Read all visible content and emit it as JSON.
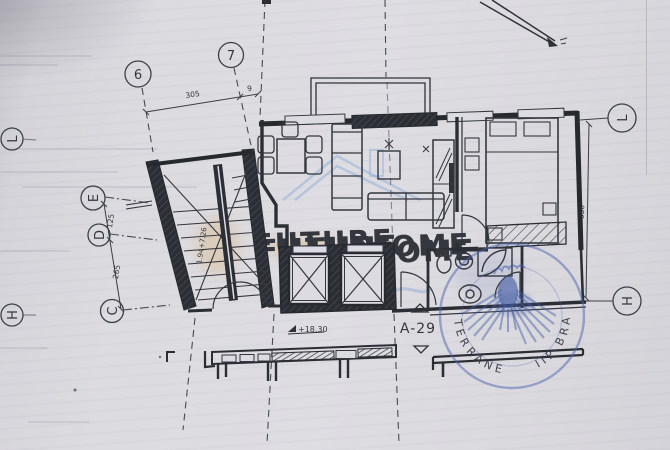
{
  "colors": {
    "paper": "#dcdbe1",
    "ink": "#34373e",
    "stamp_blue": "#4c63ae",
    "watermark_orange": "#e0a868",
    "watermark_blue": "#9fb6d8"
  },
  "grid": {
    "top": [
      "6",
      "7"
    ],
    "left": [
      "L",
      "E",
      "D",
      "C",
      "H"
    ],
    "right": [
      "L",
      "H"
    ]
  },
  "dimensions": {
    "top_span": "305",
    "top_offset": "9",
    "e_to_d": "125",
    "d_to_c": "265",
    "right_side": "630"
  },
  "stair": {
    "run_note": "1.94+7.26"
  },
  "labels": {
    "unit": "A-29",
    "elevation": "+18.30"
  },
  "watermark": {
    "word1": "FUTURE",
    "word2": "HOME"
  },
  "stamp": {
    "fragment_left": "TER",
    "fragment_bottom_left": "RANE",
    "fragment_bottom_right": "IIP",
    "fragment_right": "BRA"
  }
}
